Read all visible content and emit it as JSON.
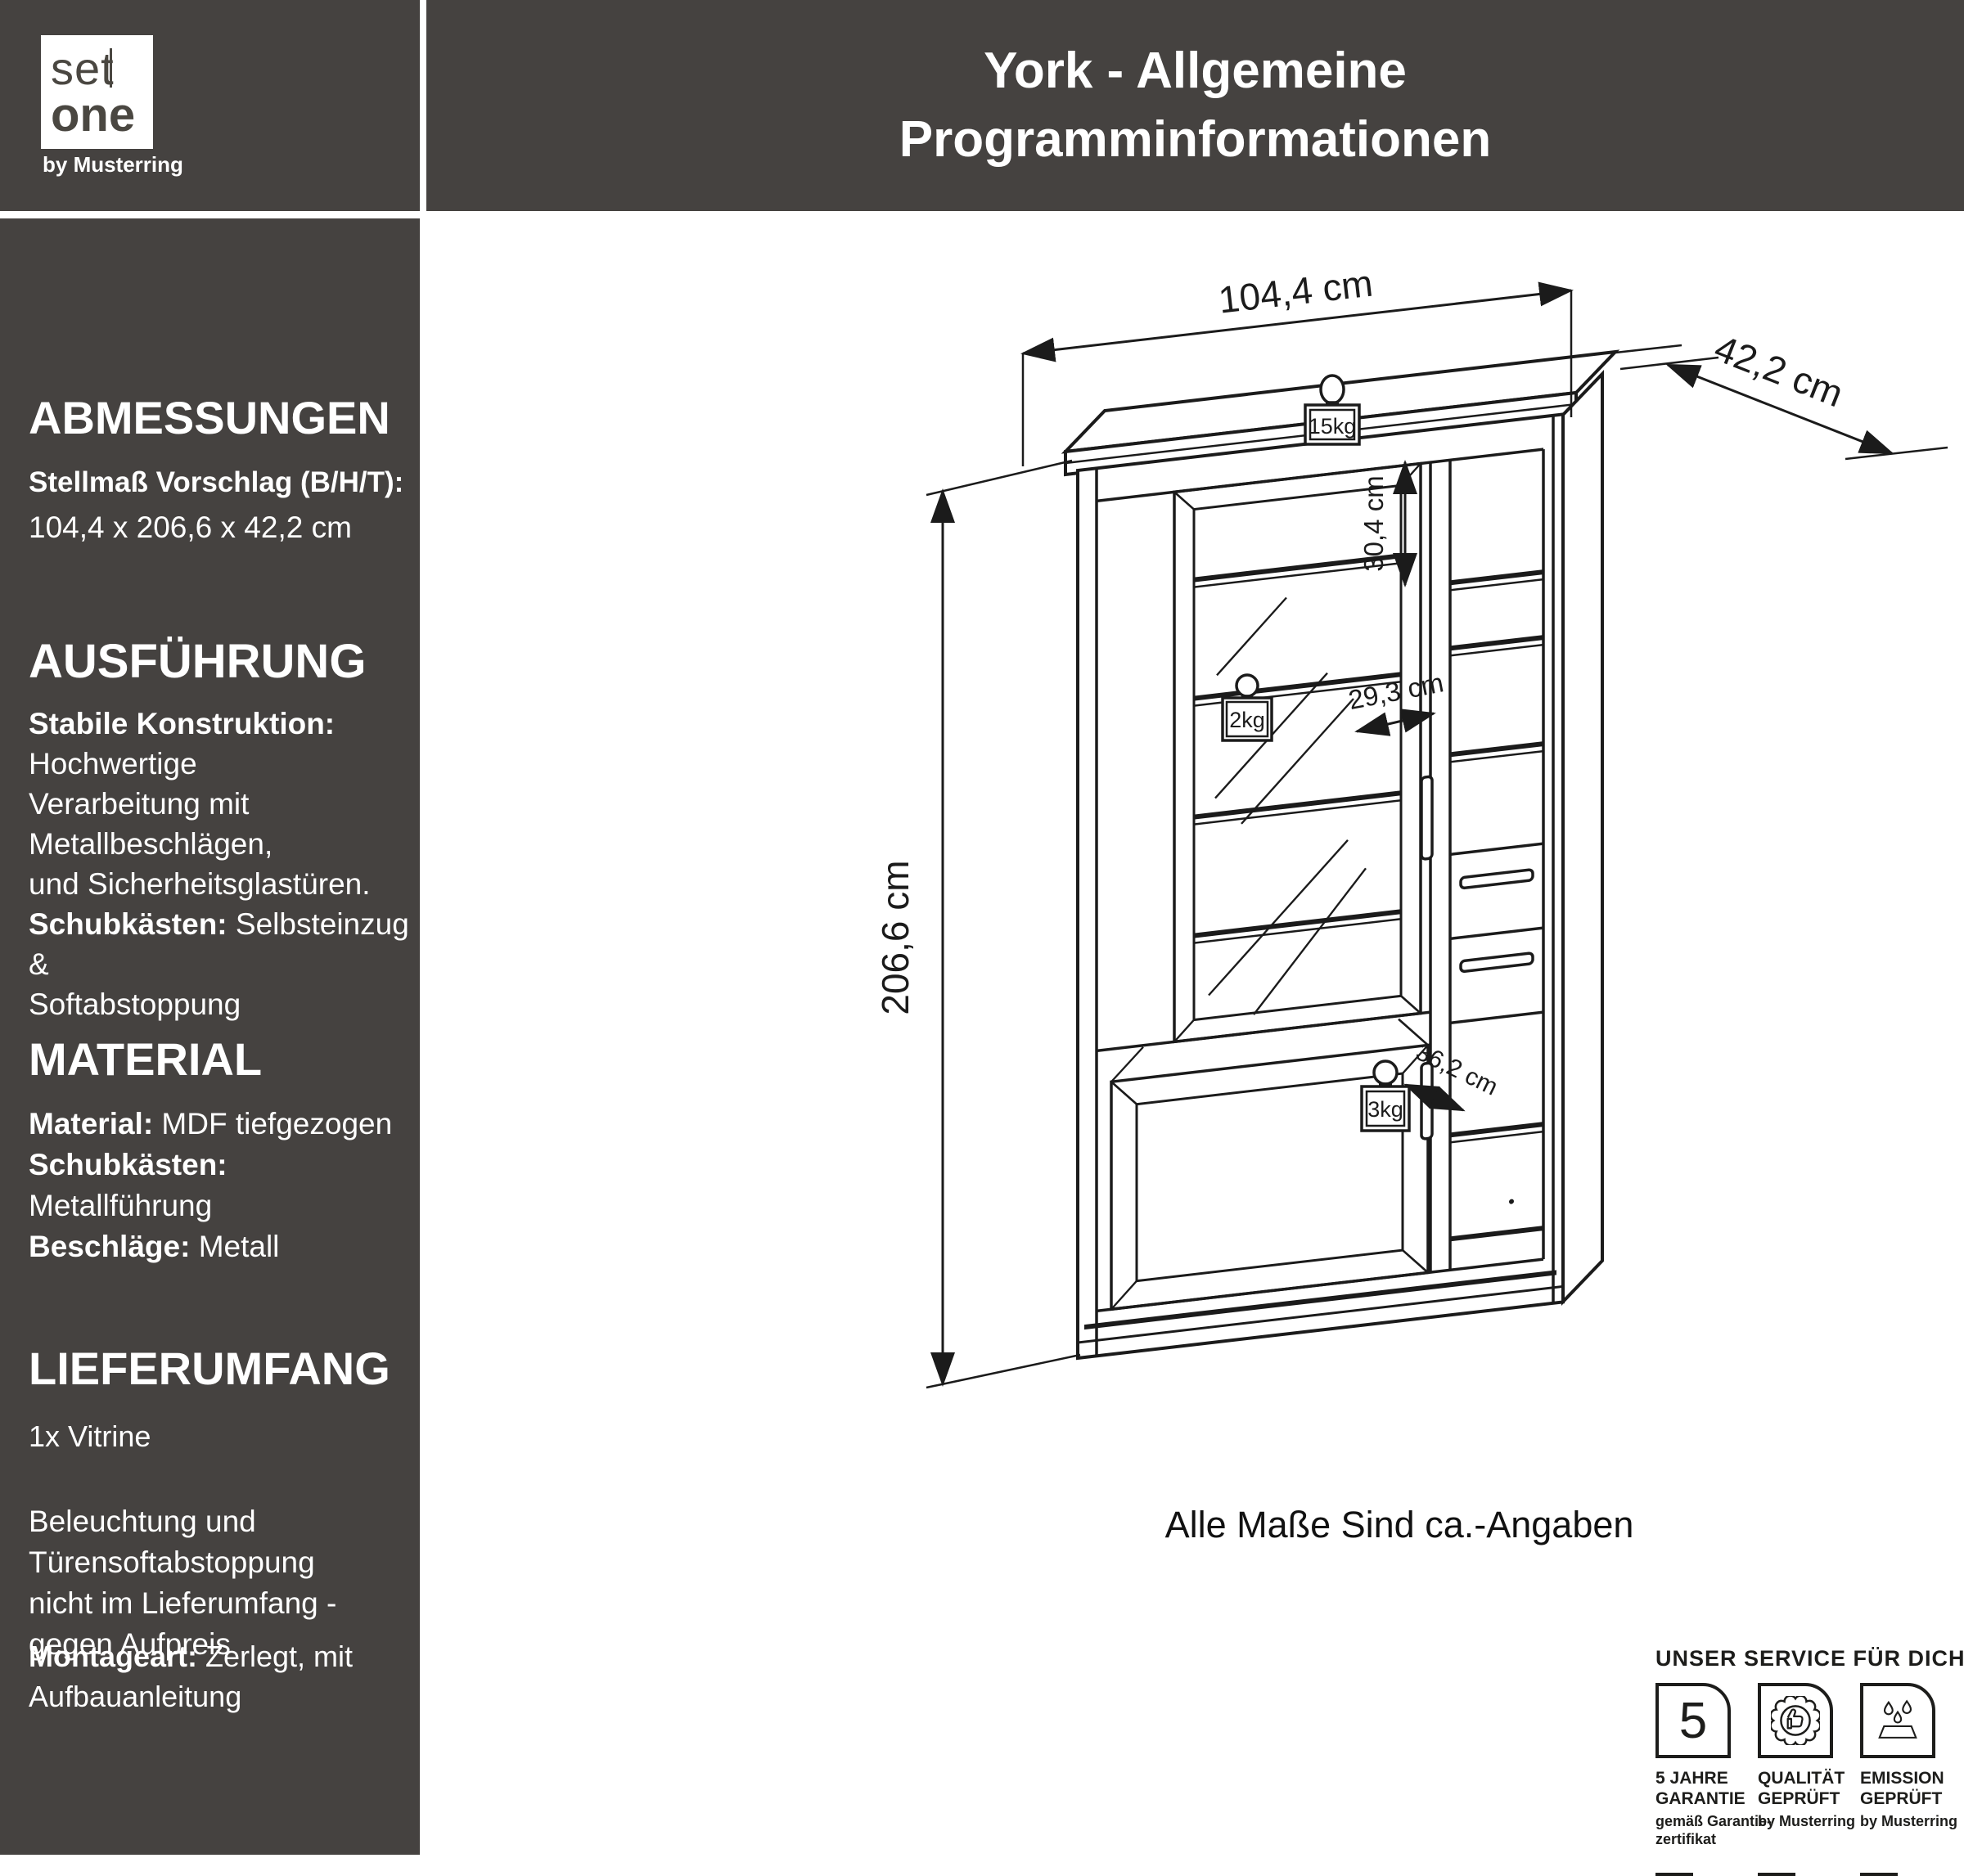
{
  "brand": {
    "set": "set",
    "one": "one",
    "byline": "by Musterring"
  },
  "header": {
    "line1": "York - Allgemeine",
    "line2": "Programminformationen"
  },
  "abmessungen": {
    "heading": "ABMESSUNGEN",
    "label": "Stellmaß Vorschlag (B/H/T):",
    "value": "104,4 x 206,6 x 42,2 cm"
  },
  "ausfuehrung": {
    "heading": "AUSFÜHRUNG",
    "l1b": "Stabile Konstruktion:",
    "l1r": " Hochwertige",
    "l2": "Verarbeitung mit Metallbeschlägen,",
    "l3": "und Sicherheitsglastüren.",
    "l4b": "Schubkästen:",
    "l4r": " Selbsteinzug &",
    "l5": "Softabstoppung"
  },
  "material": {
    "heading": "MATERIAL",
    "r1b": "Material:",
    "r1r": " MDF tiefgezogen",
    "r2b": "Schubkästen:",
    "r2r": " Metallführung",
    "r3b": "Beschläge:",
    "r3r": " Metall"
  },
  "lieferumfang": {
    "heading": "LIEFERUMFANG",
    "item": "1x Vitrine",
    "note1": "Beleuchtung und Türensoftabstoppung",
    "note2": "nicht im Lieferumfang - gegen Aufpreis",
    "montage_b": "Montageart:",
    "montage_r": " Zerlegt, mit Aufbauanleitung"
  },
  "drawing": {
    "width": "104,4 cm",
    "depth": "42,2 cm",
    "height": "206,6 cm",
    "inner_height": "30,4 cm",
    "inner_width": "29,3 cm",
    "inner_depth": "36,2 cm",
    "weight_top": "15kg",
    "weight_shelf": "2kg",
    "weight_bottom": "3kg",
    "note": "Alle Maße Sind ca.-Angaben"
  },
  "service": {
    "heading": "UNSER SERVICE FÜR DICH",
    "items": [
      {
        "t1": "5 JAHRE",
        "t2": "GARANTIE",
        "s1": "gemäß Garantie-",
        "s2": "zertifikat",
        "icon": "five-years-icon"
      },
      {
        "t1": "QUALITÄT",
        "t2": "GEPRÜFT",
        "s1": "by Musterring",
        "s2": "",
        "icon": "quality-seal-icon"
      },
      {
        "t1": "EMISSION",
        "t2": "GEPRÜFT",
        "s1": "by Musterring",
        "s2": "",
        "icon": "emission-icon"
      }
    ]
  }
}
